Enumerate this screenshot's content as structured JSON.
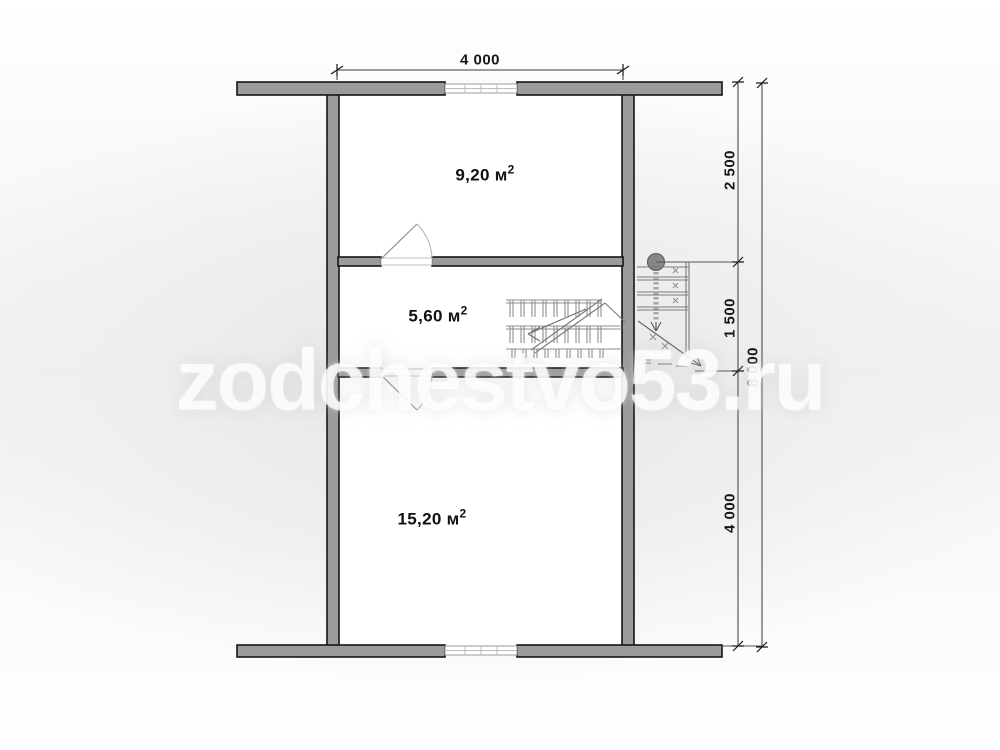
{
  "watermark": {
    "text": "zodchestvo53.ru"
  },
  "rooms": [
    {
      "area": "9,20 м",
      "sup": "2"
    },
    {
      "area": "5,60 м",
      "sup": "2"
    },
    {
      "area": "15,20 м",
      "sup": "2"
    }
  ],
  "dimensions": {
    "top_width": "4 000",
    "right_segments": [
      "2 500",
      "1 500",
      "4 000"
    ],
    "right_total": "8 000"
  }
}
